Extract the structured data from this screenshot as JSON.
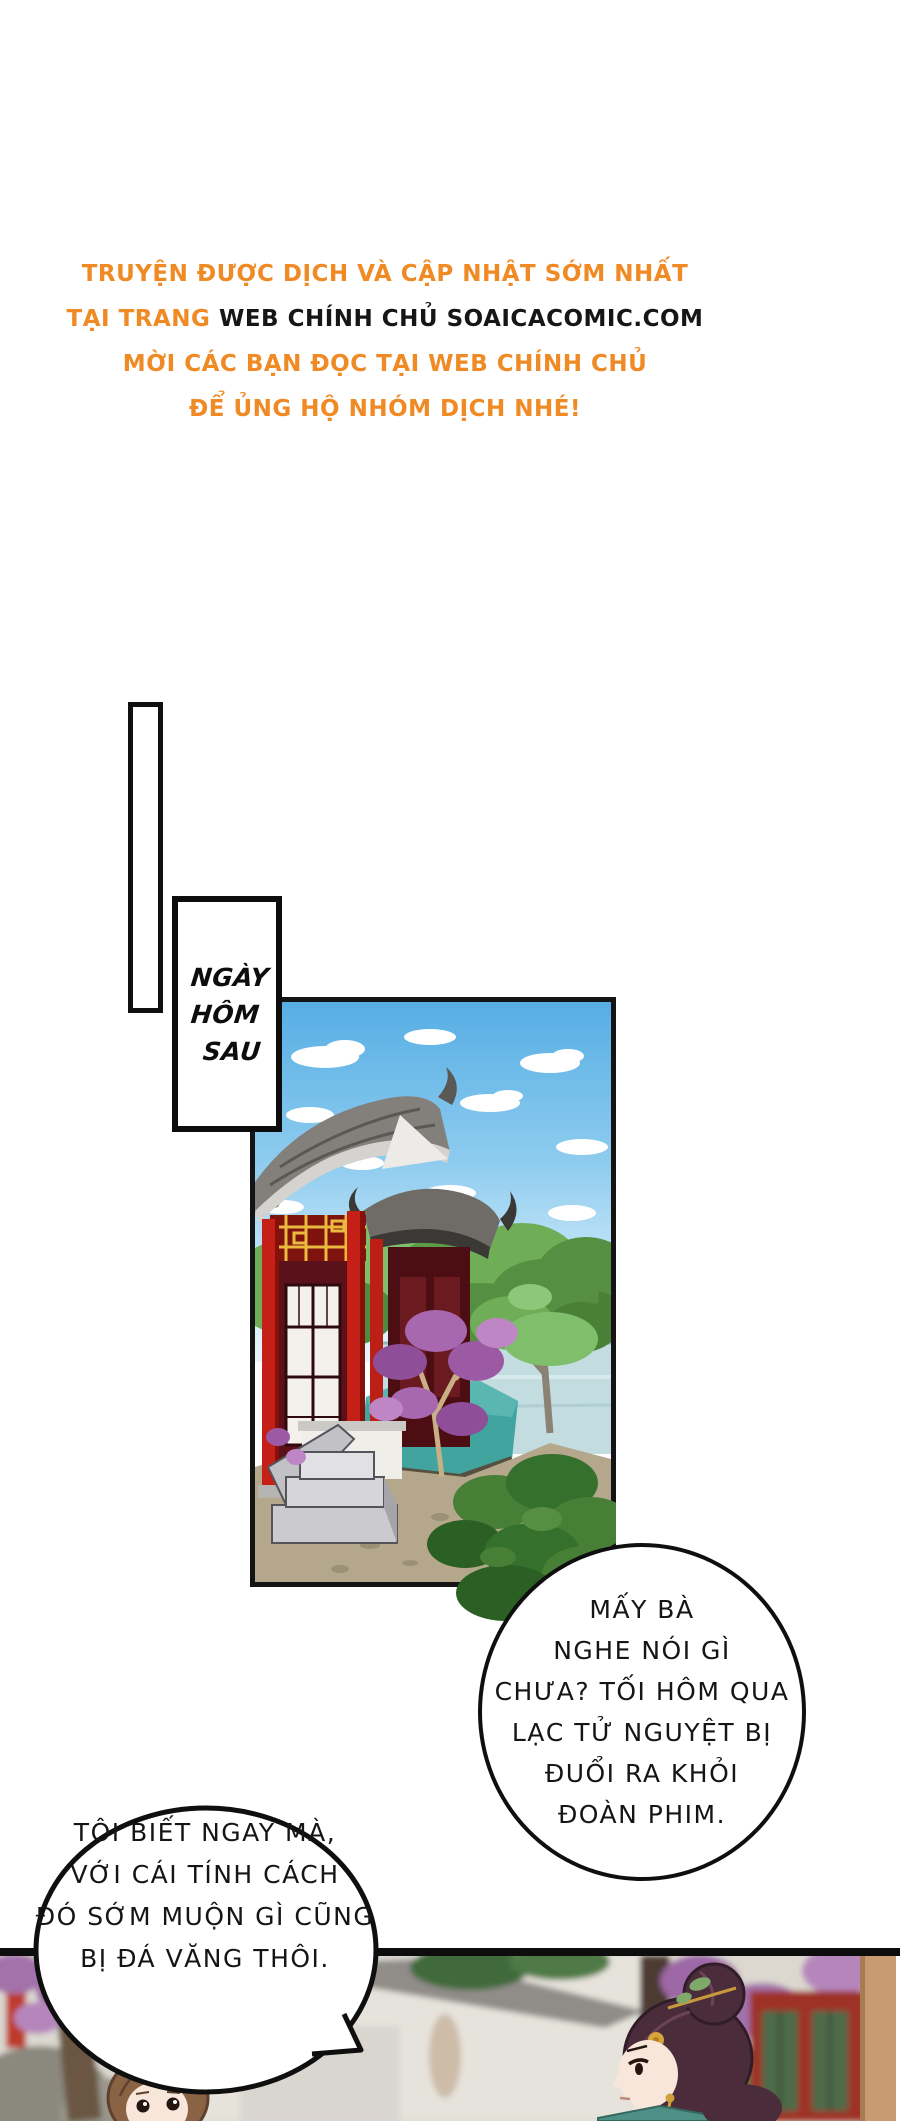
{
  "page": {
    "width": 900,
    "height": 2121,
    "background": "#ffffff"
  },
  "colors": {
    "accent_orange": "#EF8A25",
    "ink_black": "#141414",
    "sky_blue": "#5FB6E8",
    "pillar_red": "#C52017",
    "lattice_gold": "#E9BA3E",
    "blossom_purple": "#A868B0",
    "panel_white": "#ffffff"
  },
  "credits_header": {
    "line1": "TRUYỆN ĐƯỢC DỊCH VÀ CẬP NHẬT SỚM NHẤT",
    "line2_prefix": "TẠI TRANG",
    "line2_site": "WEB CHÍNH CHỦ SOAICACOMIC.COM",
    "line3": "MỜI CÁC BẠN ĐỌC TẠI WEB CHÍNH CHỦ",
    "line4": "ĐỂ ỦNG HỘ NHÓM DỊCH NHÉ!"
  },
  "caption_box": {
    "line1": "NGÀY",
    "line2": "HÔM",
    "line3": "SAU"
  },
  "bubbles": {
    "gossip": {
      "line1": "MẤY BÀ",
      "line2": "NGHE NÓI GÌ",
      "line3": "CHƯA? TỐI HÔM QUA",
      "line4": "LẠC TỬ NGUYỆT BỊ",
      "line5": "ĐUỔI RA KHỎI",
      "line6": "ĐOÀN PHIM."
    },
    "reply": {
      "line1": "TÔI BIẾT NGAY MÀ,",
      "line2": "VỚI CÁI TÍNH CÁCH",
      "line3": "ĐÓ SỚM MUỘN GÌ CŨNG",
      "line4": "BỊ ĐÁ VĂNG THÔI."
    }
  }
}
